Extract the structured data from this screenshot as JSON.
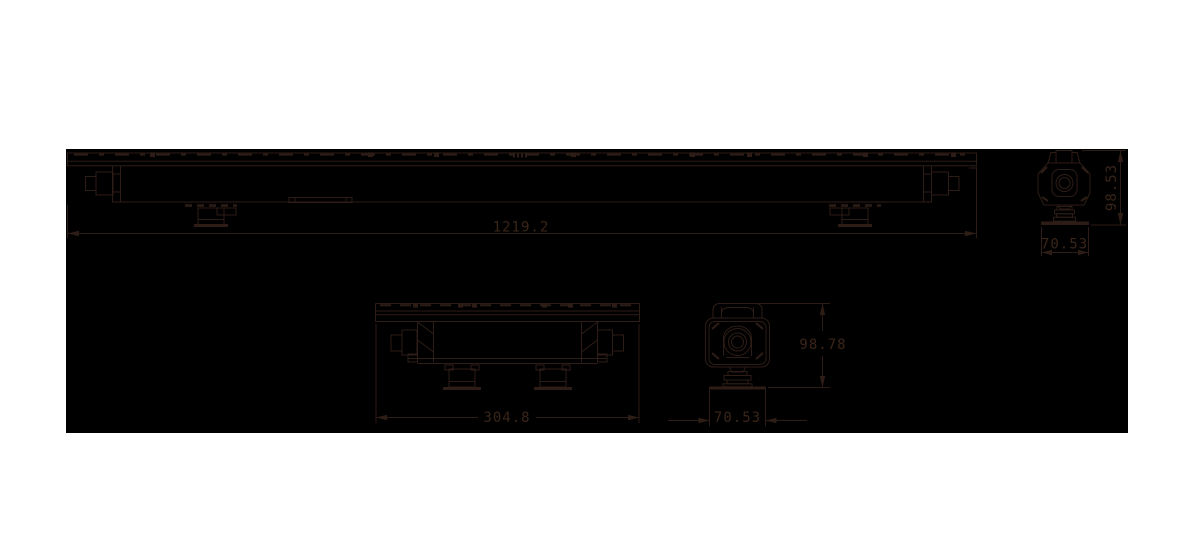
{
  "page": {
    "background": "#ffffff"
  },
  "canvas": {
    "background": "#000000",
    "line_color": "#2e1d16"
  },
  "views": {
    "front_full": {
      "dim_length": "1219.2"
    },
    "end_top": {
      "dim_height": "98.53",
      "dim_width": "70.53"
    },
    "front_module": {
      "dim_length": "304.8"
    },
    "end_bottom": {
      "dim_height": "98.78",
      "dim_width": "70.53"
    }
  }
}
